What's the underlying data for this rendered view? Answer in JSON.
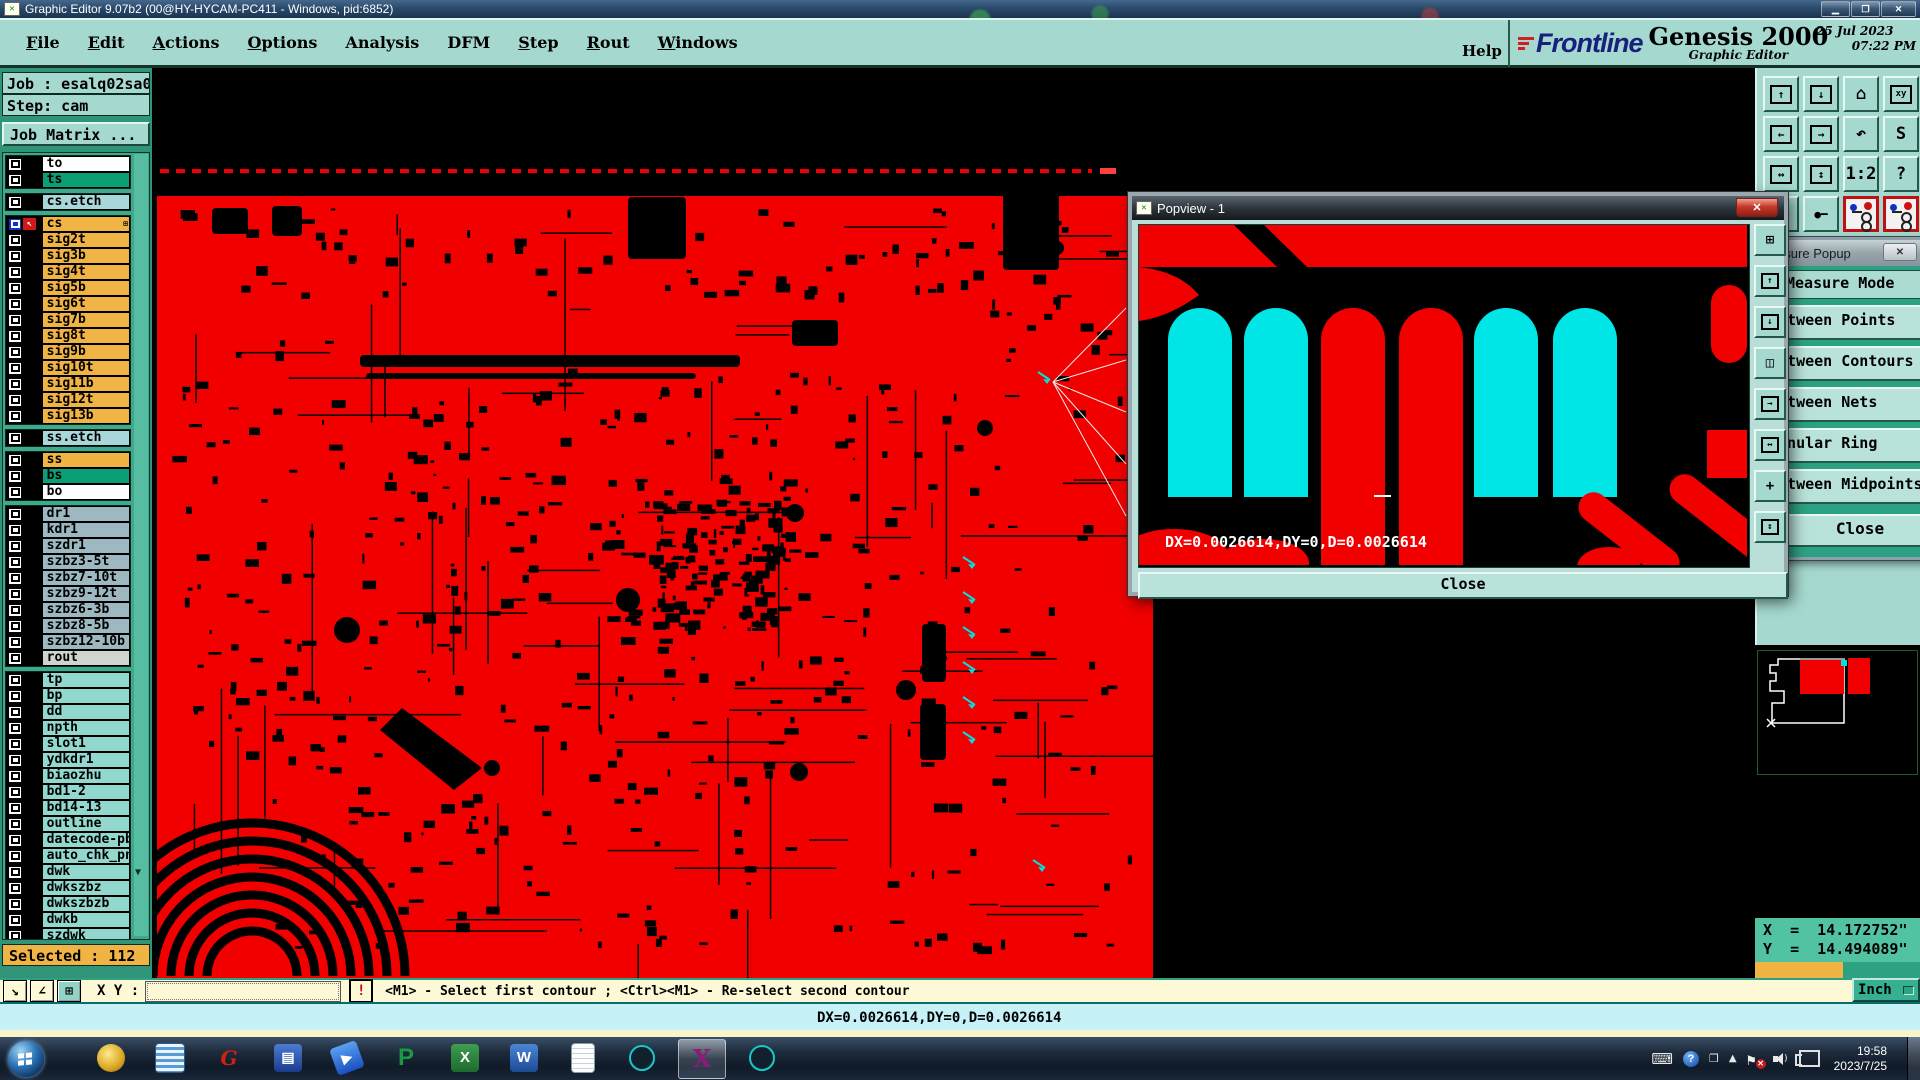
{
  "titlebar": {
    "title": "Graphic Editor 9.07b2 (00@HY-HYCAM-PC411 - Windows, pid:6852)"
  },
  "menubar": {
    "menus": [
      {
        "label": "File",
        "u": 0
      },
      {
        "label": "Edit",
        "u": 0
      },
      {
        "label": "Actions",
        "u": 0
      },
      {
        "label": "Options",
        "u": 0
      },
      {
        "label": "Analysis",
        "u": -1
      },
      {
        "label": "DFM",
        "u": -1
      },
      {
        "label": "Step",
        "u": 0
      },
      {
        "label": "Rout",
        "u": 0
      },
      {
        "label": "Windows",
        "u": 0
      }
    ],
    "help": "Help"
  },
  "brand": {
    "logo": "Frontline",
    "product": "Genesis 2000",
    "date": "25 Jul 2023",
    "time": "07:22 PM",
    "edition": "Graphic Editor"
  },
  "sidebar": {
    "job": "Job : esalq02sa0",
    "step": "Step: cam",
    "job_matrix": "Job Matrix ...",
    "selected": "Selected : 112",
    "layer_groups": [
      {
        "rows": [
          {
            "name": "to",
            "color": "#ffffff"
          },
          {
            "name": "ts",
            "color": "#0c9e74"
          }
        ]
      },
      {
        "rows": [
          {
            "name": "cs.etch",
            "color": "#a9d6d8"
          }
        ]
      },
      {
        "rows": [
          {
            "name": "cs",
            "color": "#f0b445",
            "selected": true
          },
          {
            "name": "sig2t",
            "color": "#f0b445"
          },
          {
            "name": "sig3b",
            "color": "#f0b445"
          },
          {
            "name": "sig4t",
            "color": "#f0b445"
          },
          {
            "name": "sig5b",
            "color": "#f0b445"
          },
          {
            "name": "sig6t",
            "color": "#f0b445"
          },
          {
            "name": "sig7b",
            "color": "#f0b445"
          },
          {
            "name": "sig8t",
            "color": "#f0b445"
          },
          {
            "name": "sig9b",
            "color": "#f0b445"
          },
          {
            "name": "sig10t",
            "color": "#f0b445"
          },
          {
            "name": "sig11b",
            "color": "#f0b445"
          },
          {
            "name": "sig12t",
            "color": "#f0b445"
          },
          {
            "name": "sig13b",
            "color": "#f0b445"
          }
        ]
      },
      {
        "rows": [
          {
            "name": "ss.etch",
            "color": "#a9d6d8"
          }
        ]
      },
      {
        "rows": [
          {
            "name": "ss",
            "color": "#f0b445"
          },
          {
            "name": "bs",
            "color": "#0c9e74"
          },
          {
            "name": "bo",
            "color": "#ffffff"
          }
        ]
      },
      {
        "rows": [
          {
            "name": "dr1",
            "color": "#9db8c0"
          },
          {
            "name": "kdr1",
            "color": "#9db8c0"
          },
          {
            "name": "szdr1",
            "color": "#9db8c0"
          },
          {
            "name": "szbz3-5t",
            "color": "#9db8c0"
          },
          {
            "name": "szbz7-10t",
            "color": "#9db8c0"
          },
          {
            "name": "szbz9-12t",
            "color": "#9db8c0"
          },
          {
            "name": "szbz6-3b",
            "color": "#9db8c0"
          },
          {
            "name": "szbz8-5b",
            "color": "#9db8c0"
          },
          {
            "name": "szbz12-10b",
            "color": "#9db8c0"
          },
          {
            "name": "rout",
            "color": "#cfd4cf"
          }
        ]
      },
      {
        "rows": [
          {
            "name": "tp",
            "color": "#93d8cf"
          },
          {
            "name": "bp",
            "color": "#93d8cf"
          },
          {
            "name": "dd",
            "color": "#93d8cf"
          },
          {
            "name": "npth",
            "color": "#93d8cf"
          },
          {
            "name": "slot1",
            "color": "#93d8cf"
          },
          {
            "name": "ydkdr1",
            "color": "#93d8cf"
          },
          {
            "name": "biaozhu",
            "color": "#93d8cf"
          },
          {
            "name": "bd1-2",
            "color": "#93d8cf"
          },
          {
            "name": "bd14-13",
            "color": "#93d8cf"
          },
          {
            "name": "outline",
            "color": "#93d8cf"
          },
          {
            "name": "datecode-pbo",
            "color": "#93d8cf"
          },
          {
            "name": "auto_chk_pnl",
            "color": "#93d8cf"
          },
          {
            "name": "dwk",
            "color": "#93d8cf"
          },
          {
            "name": "dwkszbz",
            "color": "#93d8cf"
          },
          {
            "name": "dwkszbzb",
            "color": "#93d8cf"
          },
          {
            "name": "dwkb",
            "color": "#93d8cf"
          },
          {
            "name": "szdwk",
            "color": "#93d8cf"
          }
        ]
      }
    ]
  },
  "toolbar": {
    "buttons": [
      {
        "name": "clipboard-in-button"
      },
      {
        "name": "clipboard-out-button"
      },
      {
        "name": "home-view-button"
      },
      {
        "name": "window-xy-button",
        "label": "xy"
      },
      {
        "name": "pan-left-button"
      },
      {
        "name": "pan-right-button"
      },
      {
        "name": "undo-view-button"
      },
      {
        "name": "s-path-button",
        "label": "S"
      },
      {
        "name": "stretch-h-button"
      },
      {
        "name": "stretch-v-button"
      },
      {
        "name": "zoom-1-2-button",
        "label": "1:2"
      },
      {
        "name": "help-button",
        "label": "?"
      },
      {
        "name": "select-net-button"
      },
      {
        "name": "trace-mode-button"
      },
      {
        "name": "netlist-a-button"
      },
      {
        "name": "netlist-b-button"
      }
    ]
  },
  "popview": {
    "title": "Popview - 1",
    "measurement": "DX=0.0026614,DY=0,D=0.0026614",
    "close_label": "Close",
    "toolbar": [
      {
        "name": "popview-new-button"
      },
      {
        "name": "view-up-button"
      },
      {
        "name": "view-down-button"
      },
      {
        "name": "split-view-button"
      },
      {
        "name": "pan-view-button"
      },
      {
        "name": "fit-view-button"
      },
      {
        "name": "center-view-button"
      },
      {
        "name": "expand-view-button"
      }
    ]
  },
  "measure": {
    "title": "Measure Popup",
    "mode_header": "Measure Mode",
    "options": [
      "Between Points",
      "Between Contours",
      "Between Nets",
      "Annular Ring",
      "Between Midpoints"
    ],
    "close_label": "Close"
  },
  "coords": {
    "x": "X  =  14.172752\"",
    "y": "Y  =  14.494089\""
  },
  "bottombar": {
    "tool_buttons": [
      {
        "name": "pointer-mode-button"
      },
      {
        "name": "angle-mode-button"
      },
      {
        "name": "grid-mode-button"
      }
    ],
    "xy_label": "X Y :",
    "input_value": "",
    "alert_label": "!",
    "prompt": "<M1> - Select first contour ; <Ctrl><M1> - Re-select second contour",
    "units": "Inch"
  },
  "statusline": {
    "text": "DX=0.0026614,DY=0,D=0.0026614"
  },
  "colors": {
    "board_copper": "#f20000",
    "pad_highlight": "#00e6e6",
    "panel_teal": "#a5d9cf"
  },
  "taskbar": {
    "apps": [
      {
        "name": "shell-app-icon"
      },
      {
        "name": "notes-app-icon"
      },
      {
        "name": "g-app-icon"
      },
      {
        "name": "floppy-64-app-icon"
      },
      {
        "name": "messenger-app-icon"
      },
      {
        "name": "p-app-icon"
      },
      {
        "name": "excel-app-icon"
      },
      {
        "name": "word-app-icon"
      },
      {
        "name": "notepad-app-icon"
      },
      {
        "name": "lens-app-icon"
      },
      {
        "name": "x-app-icon",
        "active": true
      },
      {
        "name": "lens2-app-icon"
      }
    ],
    "tray": {
      "time": "19:58",
      "date": "2023/7/25"
    }
  }
}
